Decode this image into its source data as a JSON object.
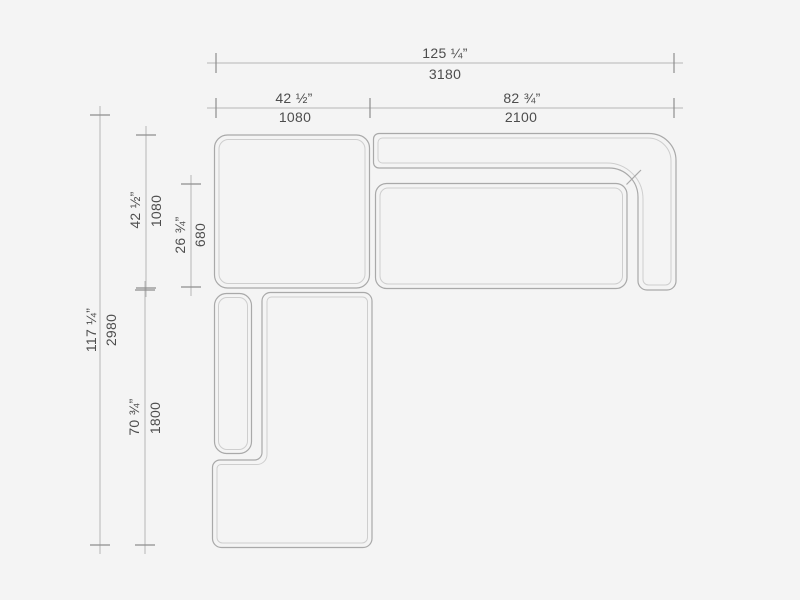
{
  "diagram": {
    "title": "sectional-sofa-top-view-dimension-drawing",
    "background_color": "#f4f4f4",
    "outline_color": "#a9a9a9",
    "inner_outline_color": "#cecece",
    "dimension_line_color": "#b6b6b6",
    "tick_color": "#8e8e8e",
    "text_color": "#4d4d4d"
  },
  "dimensions": {
    "overall_width": {
      "inches": "125 ¼”",
      "mm": "3180"
    },
    "left_module_width": {
      "inches": "42 ½”",
      "mm": "1080"
    },
    "right_module_width": {
      "inches": "82 ¾”",
      "mm": "2100"
    },
    "overall_depth": {
      "inches": "117 ¼”",
      "mm": "2980"
    },
    "top_module_depth": {
      "inches": "42 ½”",
      "mm": "1080"
    },
    "seat_depth": {
      "inches": "26 ¾”",
      "mm": "680"
    },
    "chaise_length": {
      "inches": "70 ¾”",
      "mm": "1800"
    }
  }
}
